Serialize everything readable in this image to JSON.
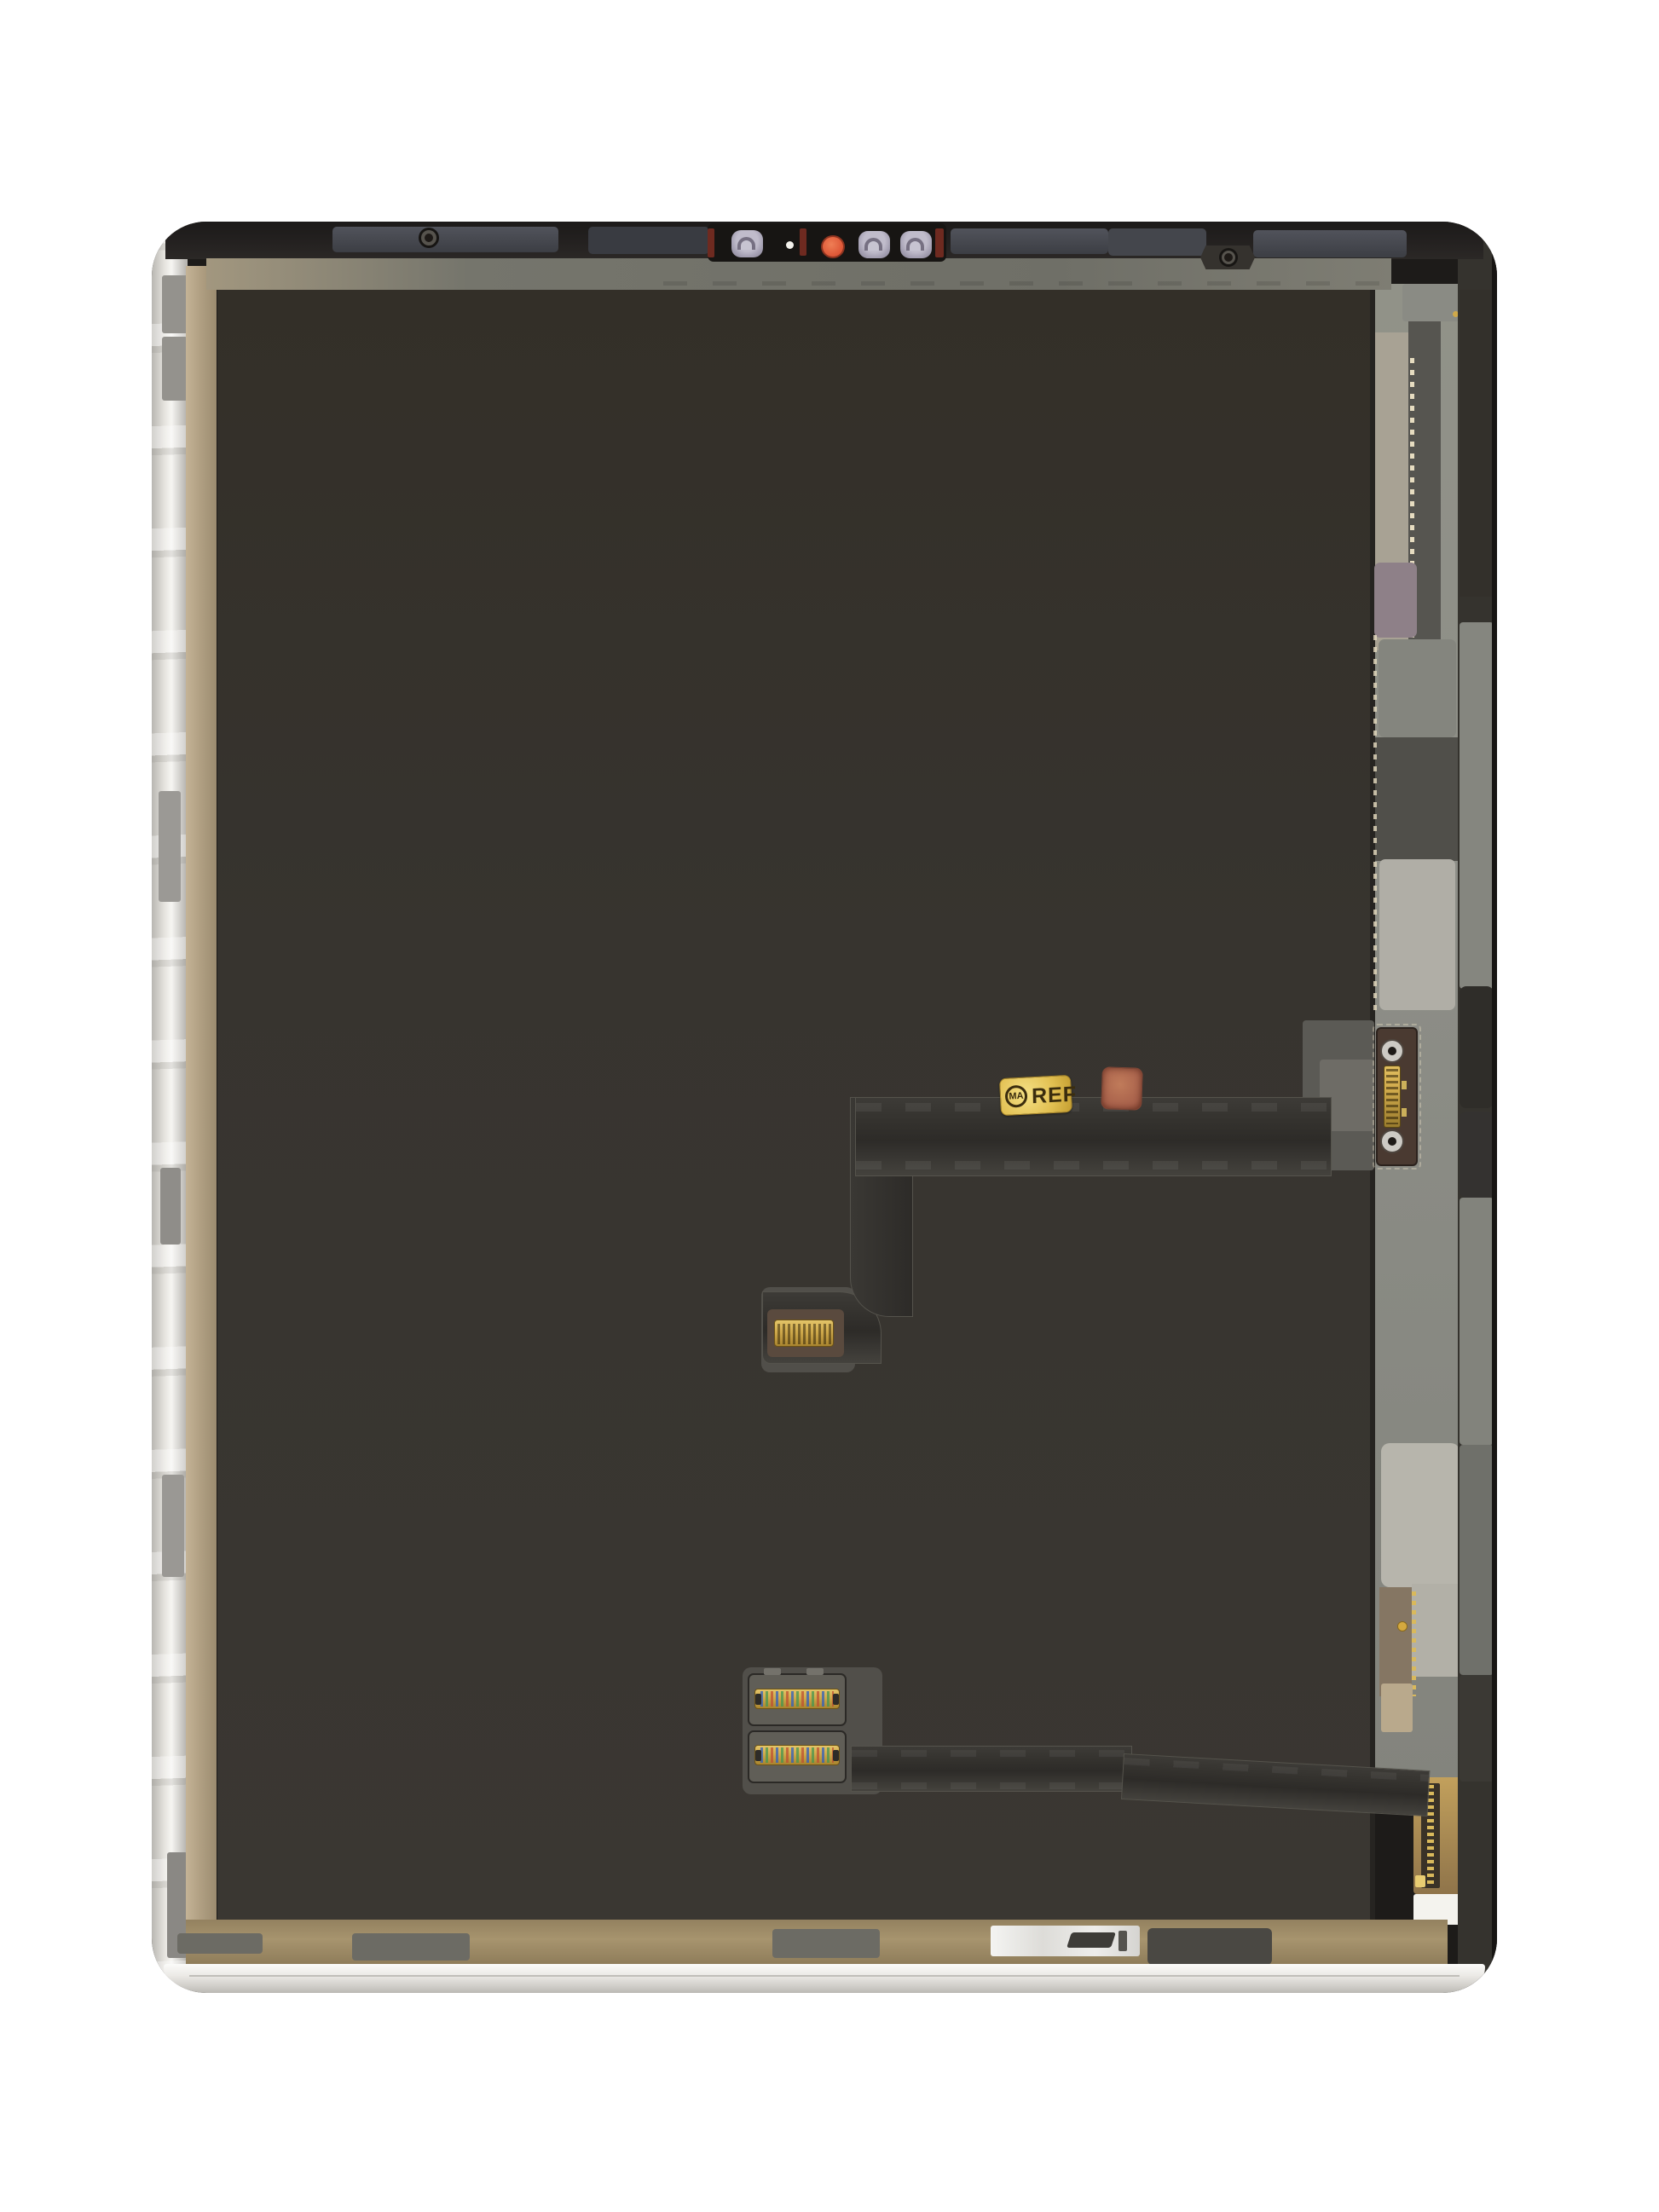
{
  "scene": {
    "description": "Product photo: rear view of a tablet LCD display assembly replacement part with flex cables, on a white background",
    "subject": "tablet-display-assembly"
  },
  "sticker": {
    "logo_text": "MA",
    "label_text": "REF"
  },
  "colors": {
    "background": "#ffffff",
    "device_rim": "#1d1b19",
    "foil": "#e8e6e1",
    "foil_shadow": "#b9b7b2",
    "adhesive": "#b1a083",
    "panel": "#37342f",
    "bezel_dark": "#242120",
    "bezel_patch": "#51535b",
    "bezel_sage": "#6f6f67",
    "bezel_tan": "#a2977f",
    "camera_black": "#171513",
    "camera_red": "#6e2a20",
    "bump": "#c0bccb",
    "bump_line": "#767082",
    "orange": "#dd5636",
    "sensor_white": "#f3f1ec",
    "strip_light": "#8d8e87",
    "pad_beige": "#a8a294",
    "pad_mauve": "#8e8088",
    "pad_med": "#84857e",
    "pad_dark": "#504f4a",
    "pad_light": "#b0aea6",
    "pad_big": "#b7b5ac",
    "notch_brown": "#857663",
    "channel": "#565550",
    "dash_ivory": "#e6dcc0",
    "edge_strip": "#35332e",
    "edge_light": "#85867f",
    "edge_dark": "#2f2d29",
    "plate_brown": "#4a3a31",
    "screw_ring": "#cdcac4",
    "screw_core": "#1e1a17",
    "gold": "#cfa94b",
    "gold_deep": "#9a7c2e",
    "flex_core": "#34322e",
    "flex_hi": "#55534c",
    "film": "#514f4a",
    "film_brown": "#5a4a3e",
    "sticker_gold": "#e2c052",
    "sticker_ink": "#3b2d0e",
    "copper": "#a8614b",
    "bottom_gold": "#a7946e",
    "pad_gray": "#6c6b64",
    "chrome": "#eeedeb",
    "pad_dark2": "#4a4843",
    "silver": "#eceae6",
    "white_pad": "#f4f3ee",
    "tan_pad": "#b9a98c"
  }
}
